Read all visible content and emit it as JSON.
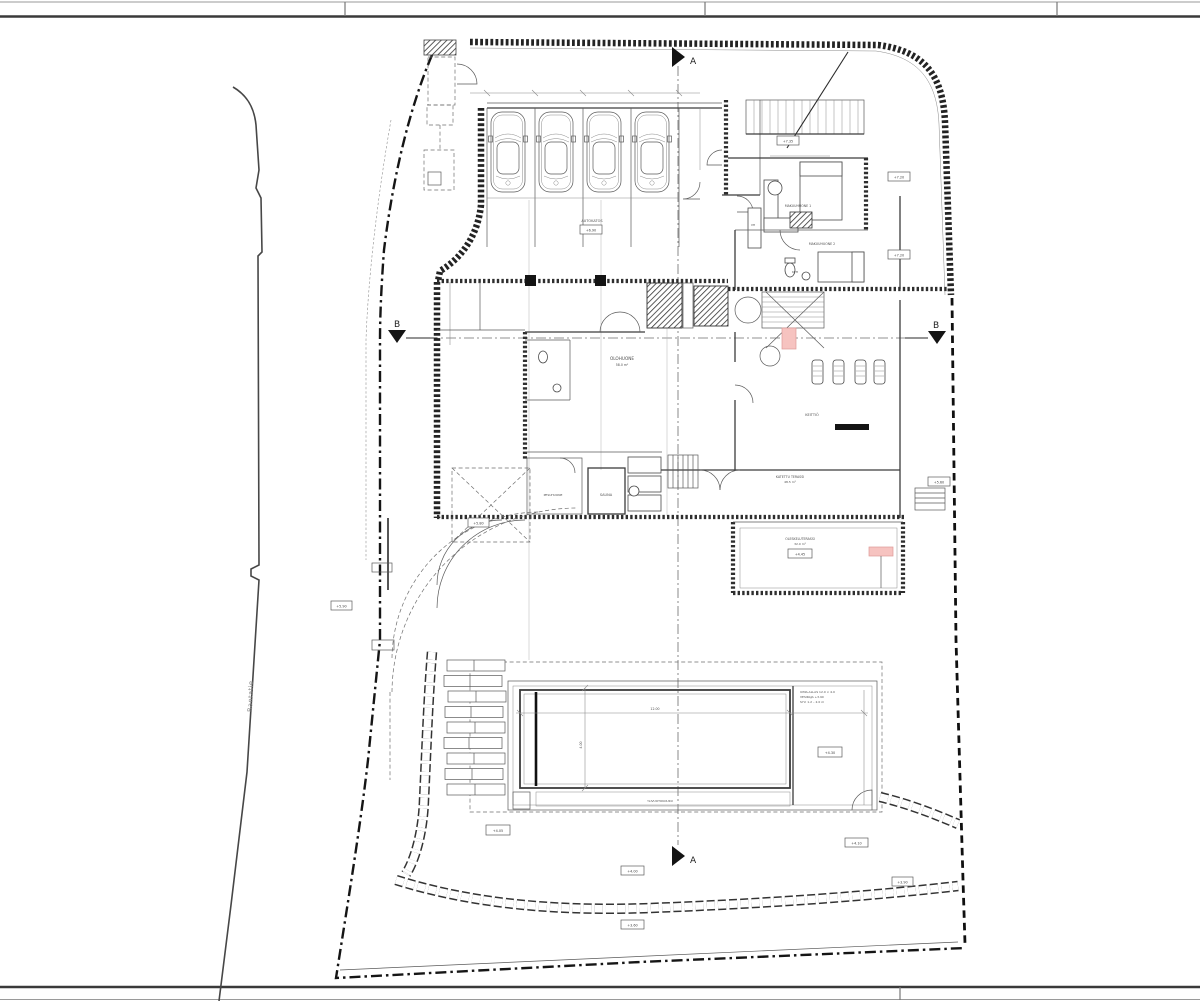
{
  "drawing": {
    "road_label": "Rantatie",
    "sections": {
      "a": "A",
      "b": "B"
    },
    "rooms": {
      "garage": "AUTOKATOS",
      "living": "OLOHUONE",
      "living_area": "58.0 m²",
      "kitchen": "KEITTIÖ",
      "bedroom1": "MAKUUHUONE 1",
      "bedroom2": "MAKUUHUONE 2",
      "bath": "KPH",
      "closet": "VH",
      "sauna": "SAUNA",
      "washroom": "PESUHUONE",
      "terrace_covered": "KATETTU TERASSI",
      "terrace_covered_area": "48.5 m²",
      "terrace_lower": "OLESKELUTERASSI",
      "terrace_lower_area": "32.0 m²"
    },
    "pool": {
      "note_line1": "UIMA-ALLAS 12.0 × 4.0",
      "note_line2": "VESIRAJA +3.90",
      "note_line3": "SYV. 1.2 – 2.0 m",
      "channel_label": "YLIVUOTOKOURU",
      "dim_width": "12.00",
      "dim_height": "4.00"
    },
    "elevations": [
      "+7.35",
      "+7.20",
      "+7.20",
      "+5.60",
      "+4.30",
      "+4.05",
      "+4.10",
      "+4.00",
      "+3.90",
      "+3.60",
      "+5.90",
      "+5.80",
      "+4.45",
      "+6.90"
    ]
  }
}
